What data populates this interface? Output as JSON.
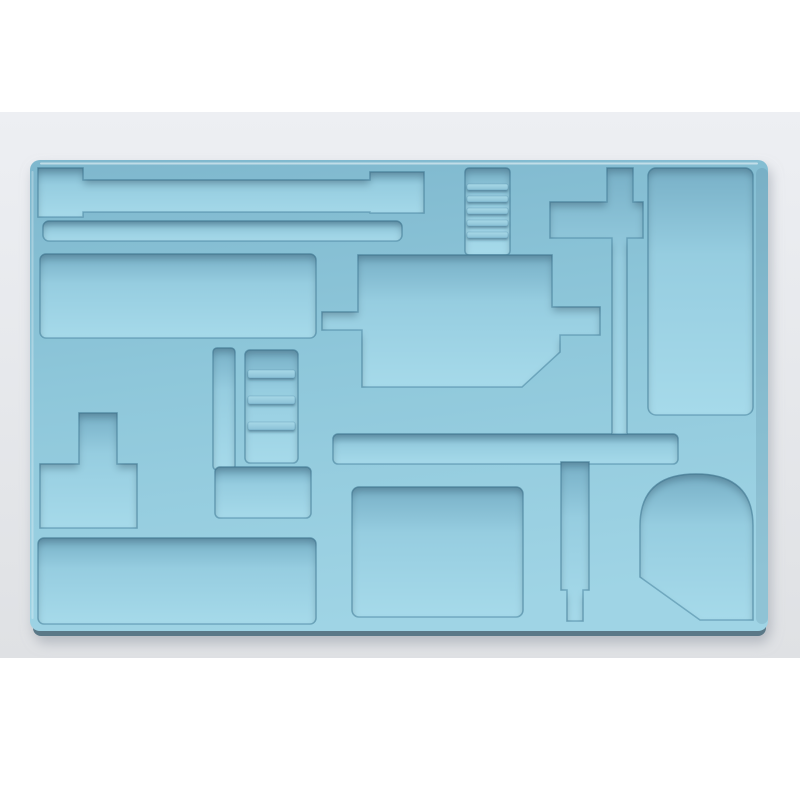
{
  "meta": {
    "alt": "Product photo of a light blue vacuum-formed plastic tray insert with many recessed compartments, on a pale gray backdrop with white bars above and below",
    "caption": "Light blue molded plastic organizer tray with rectangular slots, ladder-ribbed channels, a T-shaped recess, a large stepped central compartment and a dome-topped corner compartment."
  },
  "scene": {
    "subject": "vacuum-formed plastic tray insert (drawer / tool organizer)",
    "material": "matte light blue plastic",
    "background": "pale gray studio backdrop, white letterbox margins top and bottom",
    "lighting": "soft overhead light, shadows inside recesses, cast shadow under tray"
  },
  "palette": {
    "white_margin": "#ffffff",
    "backdrop_top": "#edeff3",
    "backdrop_bottom": "#dfe1e4",
    "tray_surface_dark": "#7fb8ce",
    "tray_surface_mid": "#8ec7da",
    "tray_surface_light": "#9fd4e5",
    "recess_top_shadow": "#78b0c7",
    "recess_floor": "#96cde0",
    "recess_floor_light": "#a6daea",
    "rung_highlight": "#a8d9e8",
    "rung_base": "#8ac1d6",
    "recess_outline": "#4c89a4",
    "tray_bottom_edge": "#5a7887",
    "cast_shadow": "#9aa0ab"
  },
  "compartments": [
    {
      "name": "slot-dogbone",
      "shape": "long horizontal slot with enlarged ends",
      "position": "top-left"
    },
    {
      "name": "slot-thin",
      "shape": "thin long horizontal slot",
      "position": "top-left"
    },
    {
      "name": "compartment-left-large",
      "shape": "wide rectangle",
      "position": "upper-left"
    },
    {
      "name": "compartment-t-shape",
      "shape": "T-shaped recess",
      "position": "mid-left"
    },
    {
      "name": "compartment-bottom-left",
      "shape": "wide rectangle",
      "position": "bottom-left"
    },
    {
      "name": "channel-vertical-left",
      "shape": "narrow vertical channel",
      "position": "center-left"
    },
    {
      "name": "ladder-slot-left",
      "shape": "vertical slot with raised rungs",
      "rungs": 3,
      "position": "center-left"
    },
    {
      "name": "compartment-left-small",
      "shape": "small rectangle",
      "position": "center-left"
    },
    {
      "name": "compartment-center-large",
      "shape": "large stepped polygon with side tabs and chamfered corner",
      "position": "center"
    },
    {
      "name": "ladder-slot-top",
      "shape": "vertical slot with raised rungs",
      "rungs": 5,
      "position": "top-center"
    },
    {
      "name": "channel-cross-top-right",
      "shape": "cross-shaped channel narrowing downward",
      "position": "top-right"
    },
    {
      "name": "compartment-right-tall",
      "shape": "tall rectangle",
      "position": "right"
    },
    {
      "name": "channel-horizontal",
      "shape": "long horizontal channel",
      "position": "center-right"
    },
    {
      "name": "channel-vertical-right",
      "shape": "vertical channel with stepped narrow end",
      "position": "bottom-center-right"
    },
    {
      "name": "compartment-bottom-middle",
      "shape": "rectangle",
      "position": "bottom-center"
    },
    {
      "name": "compartment-shield",
      "shape": "dome-topped recess with chamfered bottom-left corner",
      "position": "bottom-right"
    }
  ]
}
